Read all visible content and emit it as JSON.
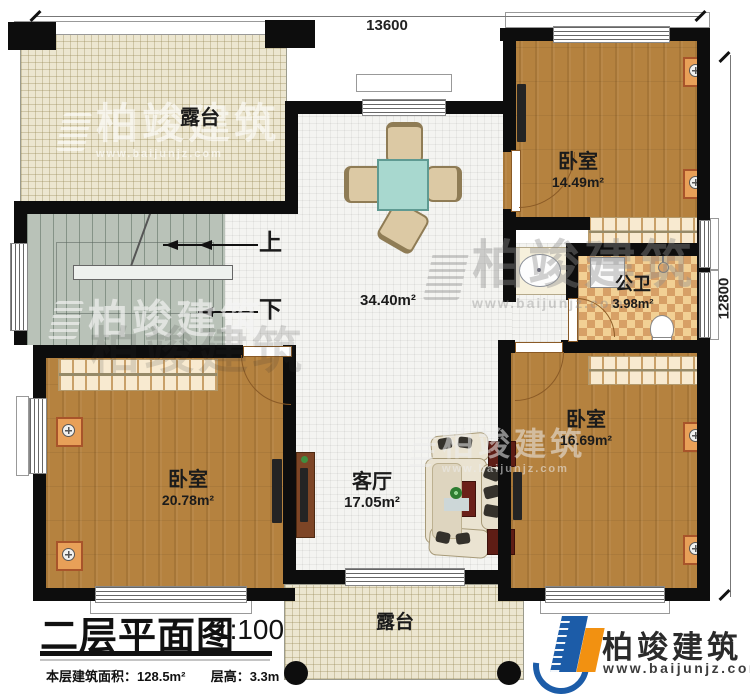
{
  "dimensions": {
    "width_label": "13600",
    "height_label": "12800"
  },
  "stairs": {
    "up_label": "上",
    "down_label": "下"
  },
  "rooms": {
    "terrace_top": {
      "name": "露台"
    },
    "hall": {
      "area": "34.40m²"
    },
    "bedroom_top_right": {
      "name": "卧室",
      "area": "14.49m²"
    },
    "bathroom": {
      "name": "公卫",
      "area": "3.98m²"
    },
    "bedroom_bottom_left": {
      "name": "卧室",
      "area": "20.78m²"
    },
    "living_room": {
      "name": "客厅",
      "area": "17.05m²"
    },
    "bedroom_bottom_right": {
      "name": "卧室",
      "area": "16.69m²"
    },
    "terrace_bottom": {
      "name": "露台"
    }
  },
  "title_block": {
    "title": "二层平面图",
    "scale": "1:100",
    "area_label": "本层建筑面积：",
    "area_value": "128.5m²",
    "floor_height_label": "层高：",
    "floor_height_value": "3.3m"
  },
  "branding": {
    "company": "柏竣建筑",
    "website": "www.baijunjz.com"
  },
  "watermark": {
    "company": "柏竣建筑",
    "website": "www.baijunjz.com"
  },
  "colors": {
    "wall": "#0d0d0d",
    "wood_floor": "#b5823f",
    "tile_floor": "#f4f4f1",
    "terrace_floor": "#ece6d0",
    "stair_floor": "#b9c2b8",
    "bathroom_tile_dark": "#d7a066",
    "bathroom_tile_light": "#f2d094",
    "bed_blue": "#79b8d5",
    "logo_blue": "#1c5ca8",
    "logo_orange": "#f29111"
  }
}
